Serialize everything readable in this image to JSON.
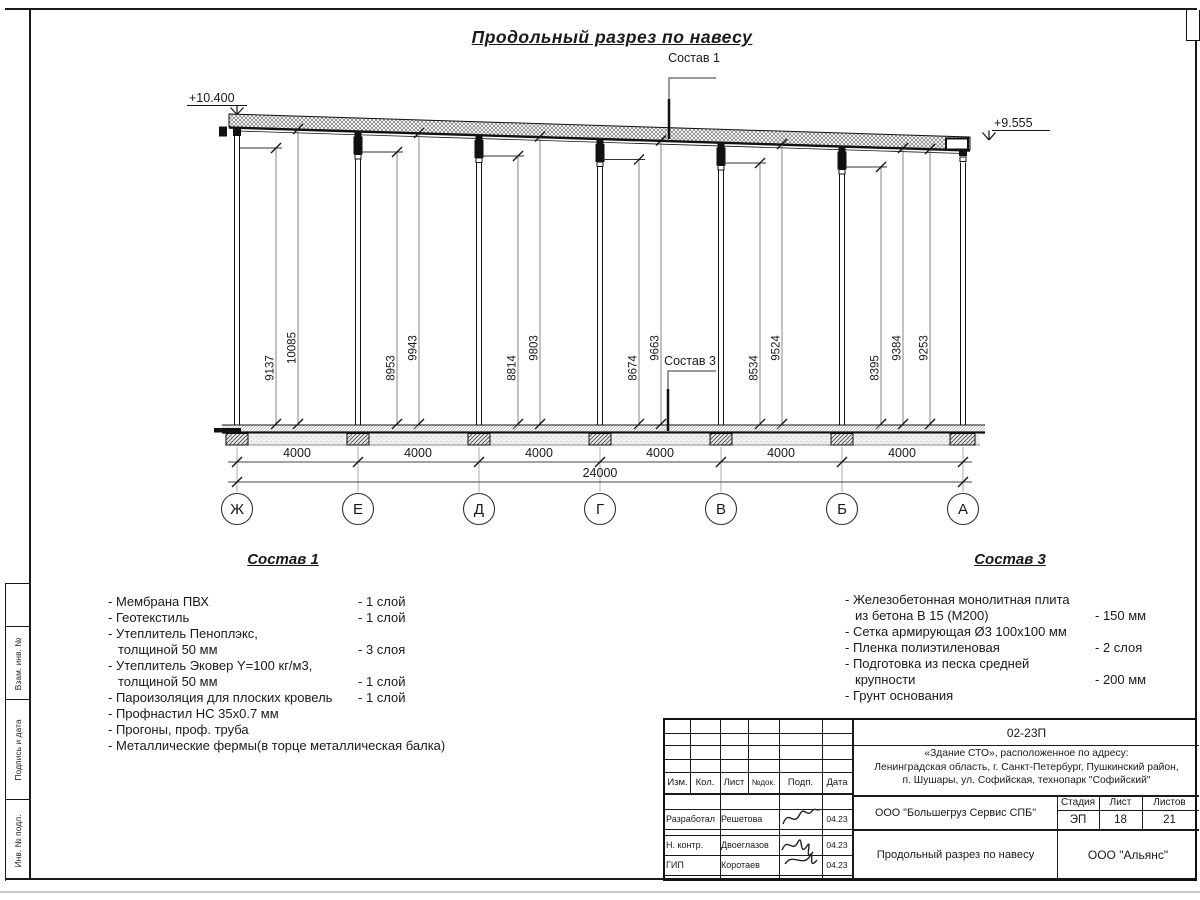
{
  "sheet": {
    "title": "Продольный разрез по навесу"
  },
  "drawing": {
    "sostav1_label": "Состав 1",
    "sostav3_label": "Состав 3",
    "elev_left": "+10.400",
    "elev_right": "+9.555",
    "total_dim": "24000",
    "bay_dims": [
      "4000",
      "4000",
      "4000",
      "4000",
      "4000",
      "4000"
    ],
    "heights": [
      "9137",
      "10085",
      "8953",
      "9943",
      "8814",
      "9803",
      "8674",
      "9663",
      "8534",
      "9524",
      "8395",
      "9384",
      "9253"
    ],
    "axes": [
      "Ж",
      "Е",
      "Д",
      "Г",
      "В",
      "Б",
      "А"
    ]
  },
  "sostav1": {
    "heading": "Состав 1",
    "items": [
      {
        "text": "- Мембрана ПВХ",
        "qty": "- 1 слой"
      },
      {
        "text": "- Геотекстиль",
        "qty": "- 1 слой"
      },
      {
        "text": "- Утеплитель Пеноплэкс,",
        "qty": ""
      },
      {
        "text": "толщиной 50 мм",
        "qty": "- 3 слоя"
      },
      {
        "text": "- Утеплитель Эковер Y=100 кг/м3,",
        "qty": ""
      },
      {
        "text": "толщиной 50 мм",
        "qty": "- 1 слой"
      },
      {
        "text": "- Пароизоляция для плоских кровель",
        "qty": "- 1 слой"
      },
      {
        "text": "- Профнастил НС 35х0.7 мм",
        "qty": ""
      },
      {
        "text": "- Прогоны, проф. труба",
        "qty": ""
      },
      {
        "text": "- Металлические фермы(в торце металлическая балка)",
        "qty": ""
      }
    ]
  },
  "sostav3": {
    "heading": "Состав 3",
    "items": [
      {
        "text": "- Железобетонная  монолитная плита",
        "qty": ""
      },
      {
        "text": "из бетона В 15 (М200)",
        "qty": "- 150 мм"
      },
      {
        "text": "- Сетка армирующая Ø3 100х100 мм",
        "qty": ""
      },
      {
        "text": "- Пленка полиэтиленовая",
        "qty": "-  2 слоя"
      },
      {
        "text": "- Подготовка из песка средней",
        "qty": ""
      },
      {
        "text": "крупности",
        "qty": "- 200 мм"
      },
      {
        "text": "- Грунт основания",
        "qty": ""
      }
    ]
  },
  "side_stamp": {
    "cell1": "Взам. инв. №",
    "cell2": "Подпись и дата",
    "cell3": "Инв. № подл."
  },
  "title_block": {
    "doc_number": "02-23П",
    "address_line1": "«Здание СТО», расположенное по адресу:",
    "address_line2": "Ленинградская область, г. Санкт-Петербург, Пушкинский район,",
    "address_line3": "п. Шушары, ул. Софийская, технопарк \"Софийский\"",
    "header": {
      "izm": "Изм.",
      "kol": "Кол.",
      "list": "Лист",
      "ndok": "№док.",
      "podp": "Подп.",
      "data": "Дата"
    },
    "rows": [
      {
        "role": "Разработал",
        "name": "Решетова",
        "date": "04.23"
      },
      {
        "role": "Н. контр.",
        "name": "Двоеглазов",
        "date": "04.23"
      },
      {
        "role": "ГИП",
        "name": "Коротаев",
        "date": "04.23"
      }
    ],
    "company": "ООО \"Большегруз Сервис СПБ\"",
    "sheet_title": "Продольный разрез по навесу",
    "org": "ООО \"Альянс\"",
    "stage_label": "Стадия",
    "sheet_label": "Лист",
    "sheets_label": "Листов",
    "stage": "ЭП",
    "sheet_num": "18",
    "sheets_total": "21"
  }
}
